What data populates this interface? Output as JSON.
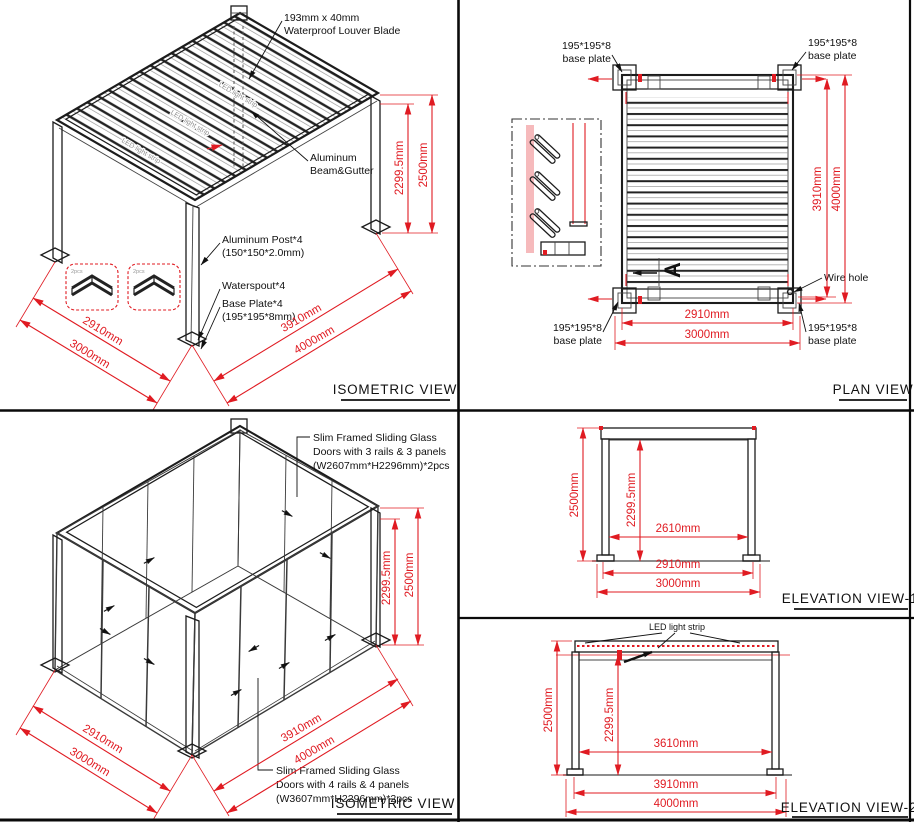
{
  "colors": {
    "dimension_red": "#e01b22",
    "line_black": "#1c1c1c"
  },
  "iso_top": {
    "title": "ISOMETRIC VIEW",
    "louver_label_1": "193mm x 40mm",
    "louver_label_2": "Waterproof Louver Blade",
    "beam_label_1": "Aluminum",
    "beam_label_2": "Beam&Gutter",
    "post_label_1": "Aluminum Post*4",
    "post_label_2": "(150*150*2.0mm)",
    "waterspout_label": "Waterspout*4",
    "baseplate_label_1": "Base Plate*4",
    "baseplate_label_2": "(195*195*8mm)",
    "led_strip_text": "LED light strip",
    "bracket_qty": "2pcs",
    "dim_height_inner": "2299.5mm",
    "dim_height_total": "2500mm",
    "dim_width_inner": "2910mm",
    "dim_width_total": "3000mm",
    "dim_depth_inner": "3910mm",
    "dim_depth_total": "4000mm"
  },
  "plan": {
    "title": "PLAN VIEW",
    "baseplate_line1": "195*195*8",
    "baseplate_line2": "base plate",
    "wire_hole_label": "Wire hole",
    "section_marker": "A",
    "dim_depth_inner": "3910mm",
    "dim_depth_total": "4000mm",
    "dim_width_inner": "2910mm",
    "dim_width_total": "3000mm"
  },
  "iso_bottom": {
    "title": "ISOMETRIC VIEW",
    "doors3_label_1": "Slim Framed Sliding Glass",
    "doors3_label_2": "Doors with 3 rails & 3 panels",
    "doors3_label_3": "(W2607mm*H2296mm)*2pcs",
    "doors4_label_1": "Slim Framed Sliding Glass",
    "doors4_label_2": "Doors with 4 rails & 4 panels",
    "doors4_label_3": "(W3607mm*H2296mm)*2pcs",
    "dim_height_inner": "2299.5mm",
    "dim_height_total": "2500mm",
    "dim_width_inner": "2910mm",
    "dim_width_total": "3000mm",
    "dim_depth_inner": "3910mm",
    "dim_depth_total": "4000mm"
  },
  "elev1": {
    "title": "ELEVATION VIEW-1",
    "dim_height_total": "2500mm",
    "dim_height_inner": "2299.5mm",
    "dim_opening": "2610mm",
    "dim_width_inner": "2910mm",
    "dim_width_total": "3000mm"
  },
  "elev2": {
    "title": "ELEVATION VIEW-2",
    "led_strip_label": "LED light strip",
    "dim_height_total": "2500mm",
    "dim_height_inner": "2299.5mm",
    "dim_opening": "3610mm",
    "dim_depth_inner": "3910mm",
    "dim_depth_total": "4000mm"
  }
}
